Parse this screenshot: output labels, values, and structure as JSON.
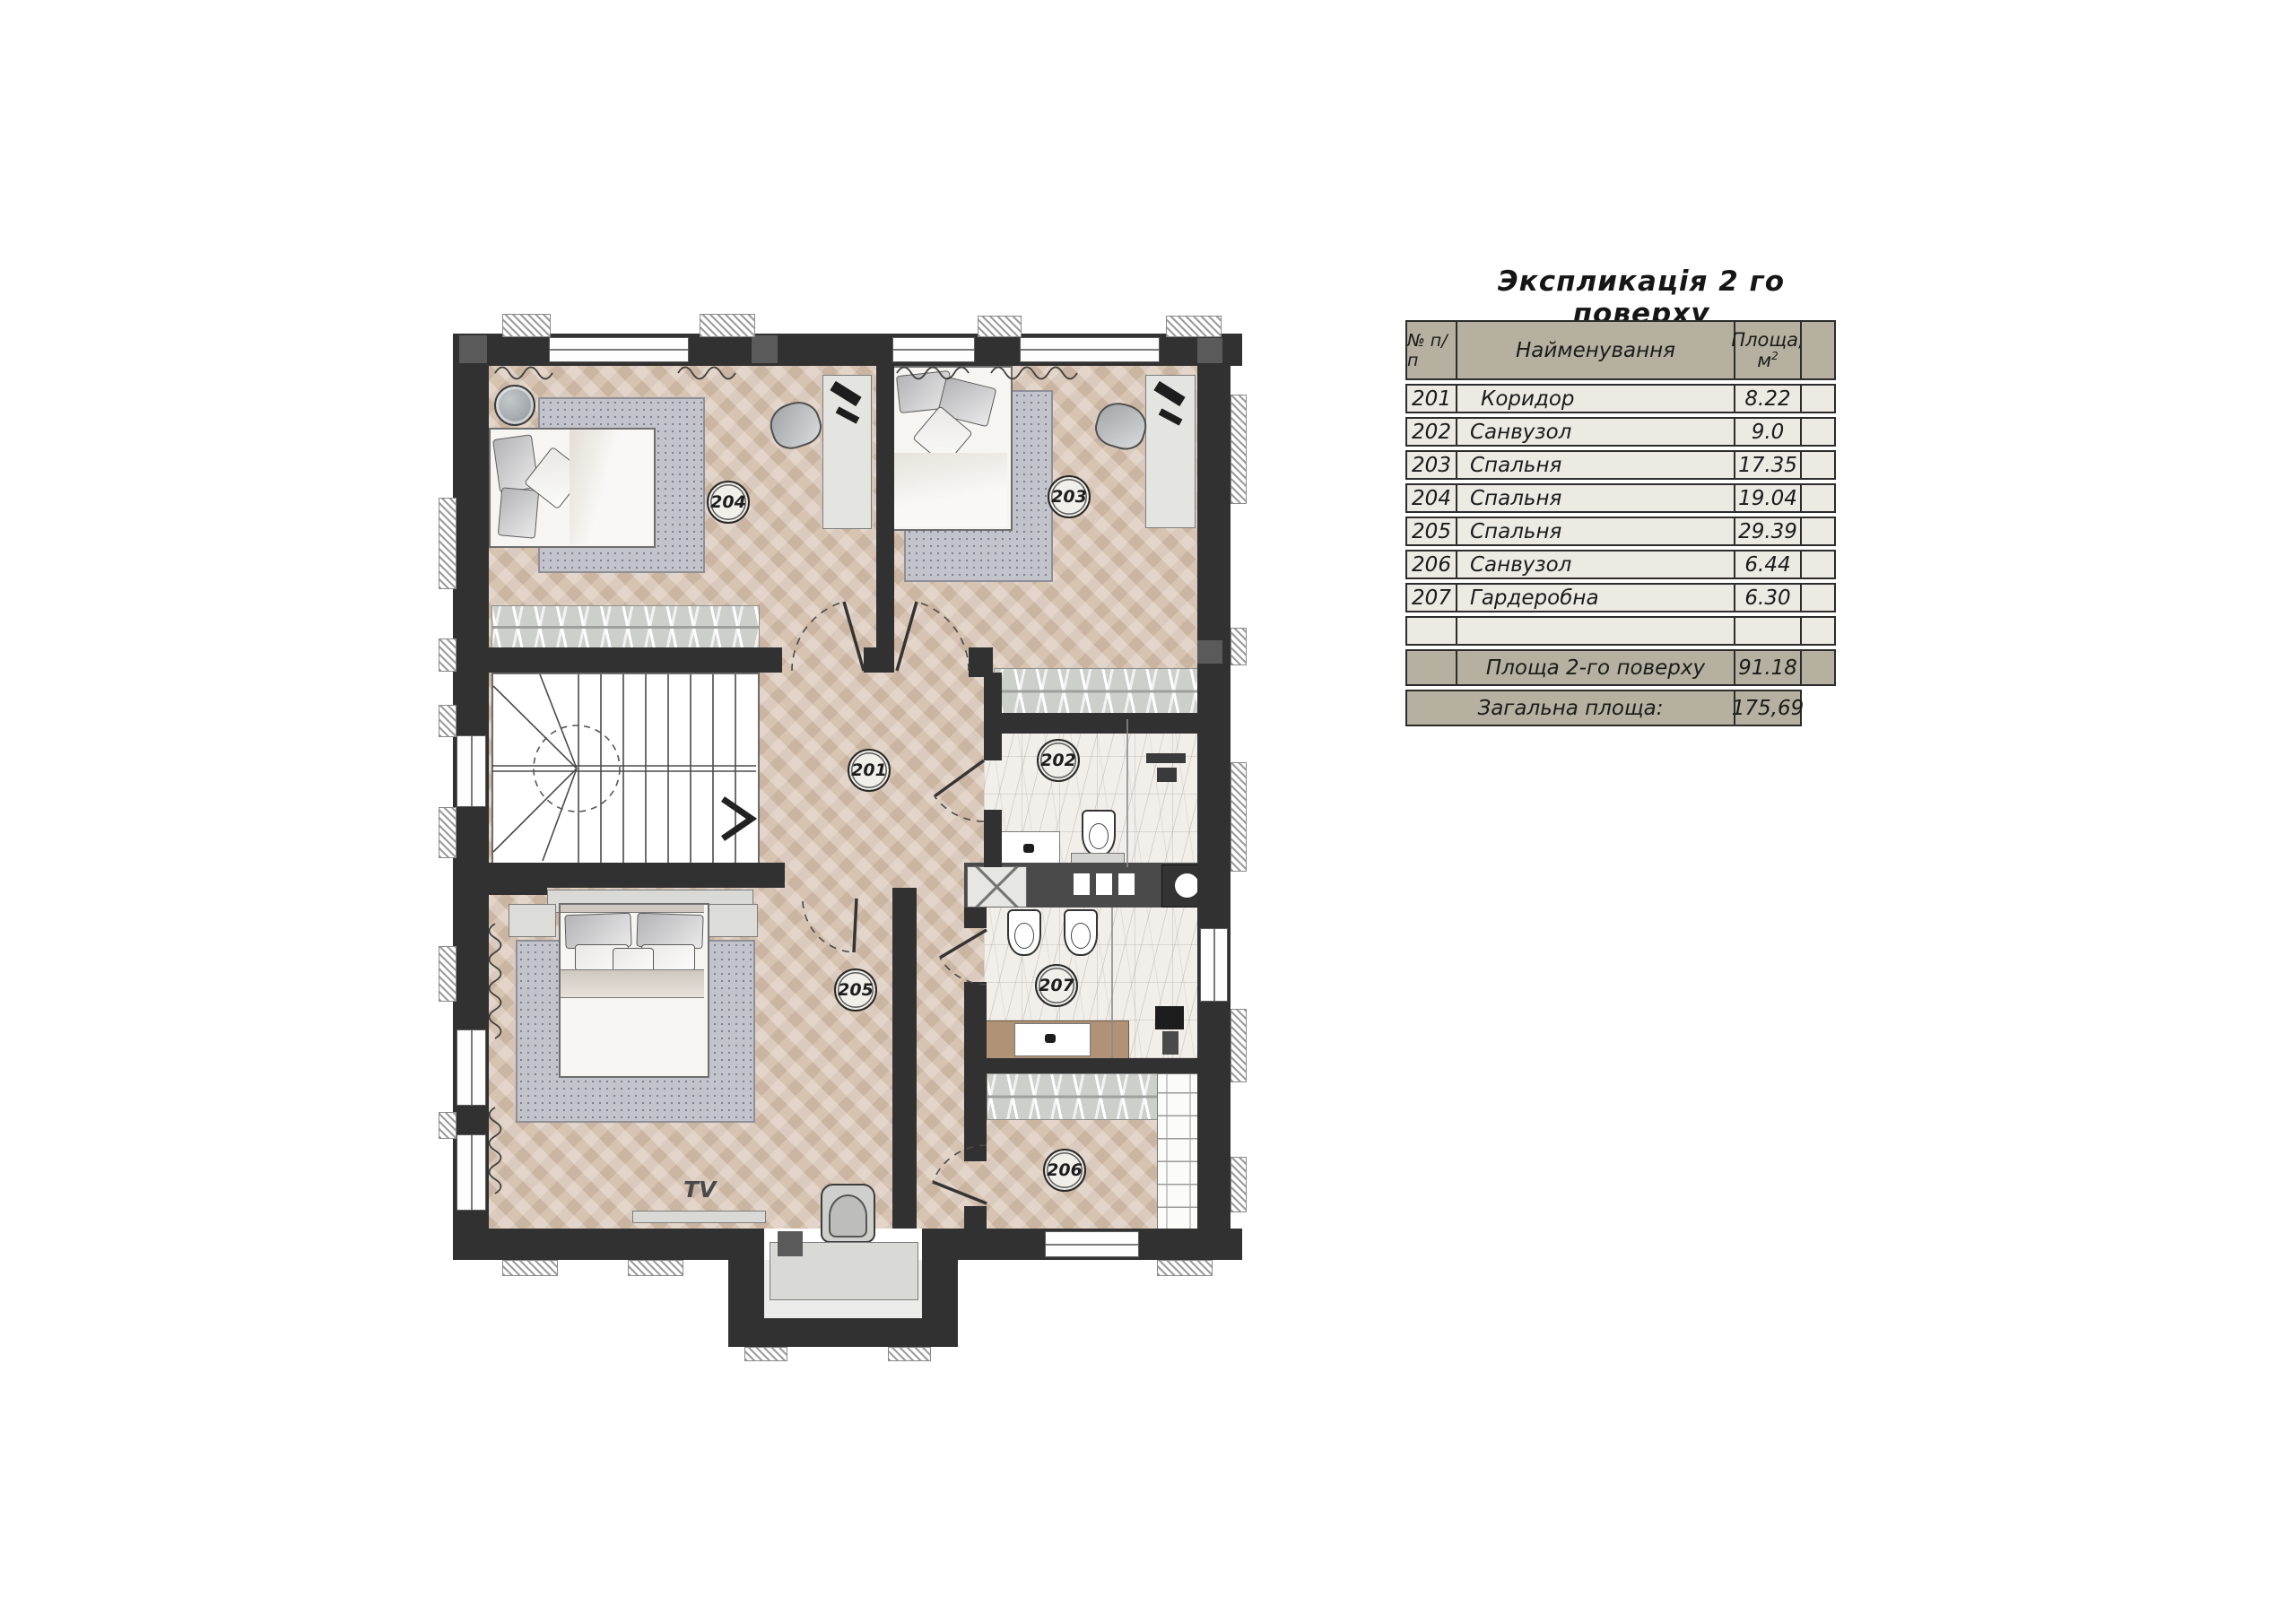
{
  "title": "Экспликація 2 го поверху",
  "table": {
    "col_num": "№ п/п",
    "col_name": "Найменування",
    "col_area_line1": "Площа,",
    "col_area_unit": "м",
    "col_area_sup": "2",
    "rows": [
      {
        "num": "201",
        "name": "Коридор",
        "area": "8.22"
      },
      {
        "num": "202",
        "name": "Санвузол",
        "area": "9.0"
      },
      {
        "num": "203",
        "name": "Спальня",
        "area": "17.35"
      },
      {
        "num": "204",
        "name": "Спальня",
        "area": "19.04"
      },
      {
        "num": "205",
        "name": "Спальня",
        "area": "29.39"
      },
      {
        "num": "206",
        "name": "Санвузол",
        "area": "6.44"
      },
      {
        "num": "207",
        "name": "Гардеробна",
        "area": "6.30"
      }
    ],
    "floor_total_label": "Площа 2-го поверху",
    "floor_total_value": "91.18",
    "grand_total_label": "Загальна площа:",
    "grand_total_value": "175,69"
  },
  "plan": {
    "labels": {
      "r201": "201",
      "r202": "202",
      "r203": "203",
      "r204": "204",
      "r205": "205",
      "r206": "206",
      "r207": "207"
    },
    "tv_label": "TV"
  },
  "colors": {
    "wall": "#313131",
    "floor_wood": "#d7c3b1",
    "marble": "#f2efeb",
    "rug": "#c3c3cb",
    "table_header_bg": "#b5b09f",
    "table_row_bg": "#eceae3"
  }
}
